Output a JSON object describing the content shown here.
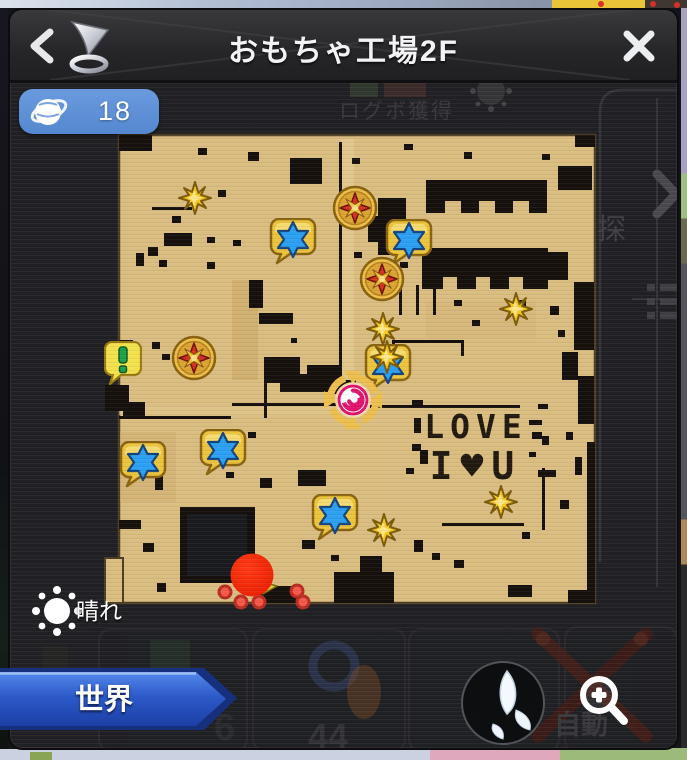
{
  "header": {
    "title": "おもちゃ工場2F",
    "back": "‹",
    "close": "✕"
  },
  "world_badge": {
    "count": "18"
  },
  "weather": {
    "label": "晴れ"
  },
  "world_button": {
    "label": "世界"
  },
  "map": {
    "graffiti": {
      "line1": "LOVE",
      "line2": "I♥U"
    },
    "markers": {
      "quest_star_blue": [
        [
          283,
          232
        ],
        [
          399,
          233
        ],
        [
          378,
          358
        ],
        [
          213,
          443
        ],
        [
          133,
          455
        ],
        [
          325,
          508
        ]
      ],
      "compass_star_red": [
        [
          345,
          198
        ],
        [
          372,
          269
        ],
        [
          184,
          348
        ]
      ],
      "sparkle_gold": [
        [
          185,
          188
        ],
        [
          373,
          319
        ],
        [
          377,
          347
        ],
        [
          506,
          299
        ],
        [
          491,
          492
        ],
        [
          374,
          520
        ]
      ],
      "exclamation": [
        [
          113,
          353
        ]
      ],
      "portal_spiral": [
        [
          343,
          390
        ]
      ],
      "direction_pointer": [
        [
          257,
          577
        ]
      ],
      "small_player_dots": [
        [
          215,
          582
        ],
        [
          231,
          592
        ],
        [
          249,
          592
        ],
        [
          287,
          581
        ],
        [
          293,
          592
        ]
      ],
      "player": [
        [
          242,
          565
        ]
      ]
    }
  },
  "background": {
    "login_text": "ログボ獲得",
    "explore_text": "探",
    "auto_text": "自動",
    "slot_numbers": [
      "44",
      "6",
      "1",
      "7"
    ]
  },
  "colors": {
    "accent_blue": "#5e90d6",
    "banner_blue": "#2d5ac8",
    "map_tan": "#dabd81",
    "player_red": "#f3270c"
  }
}
